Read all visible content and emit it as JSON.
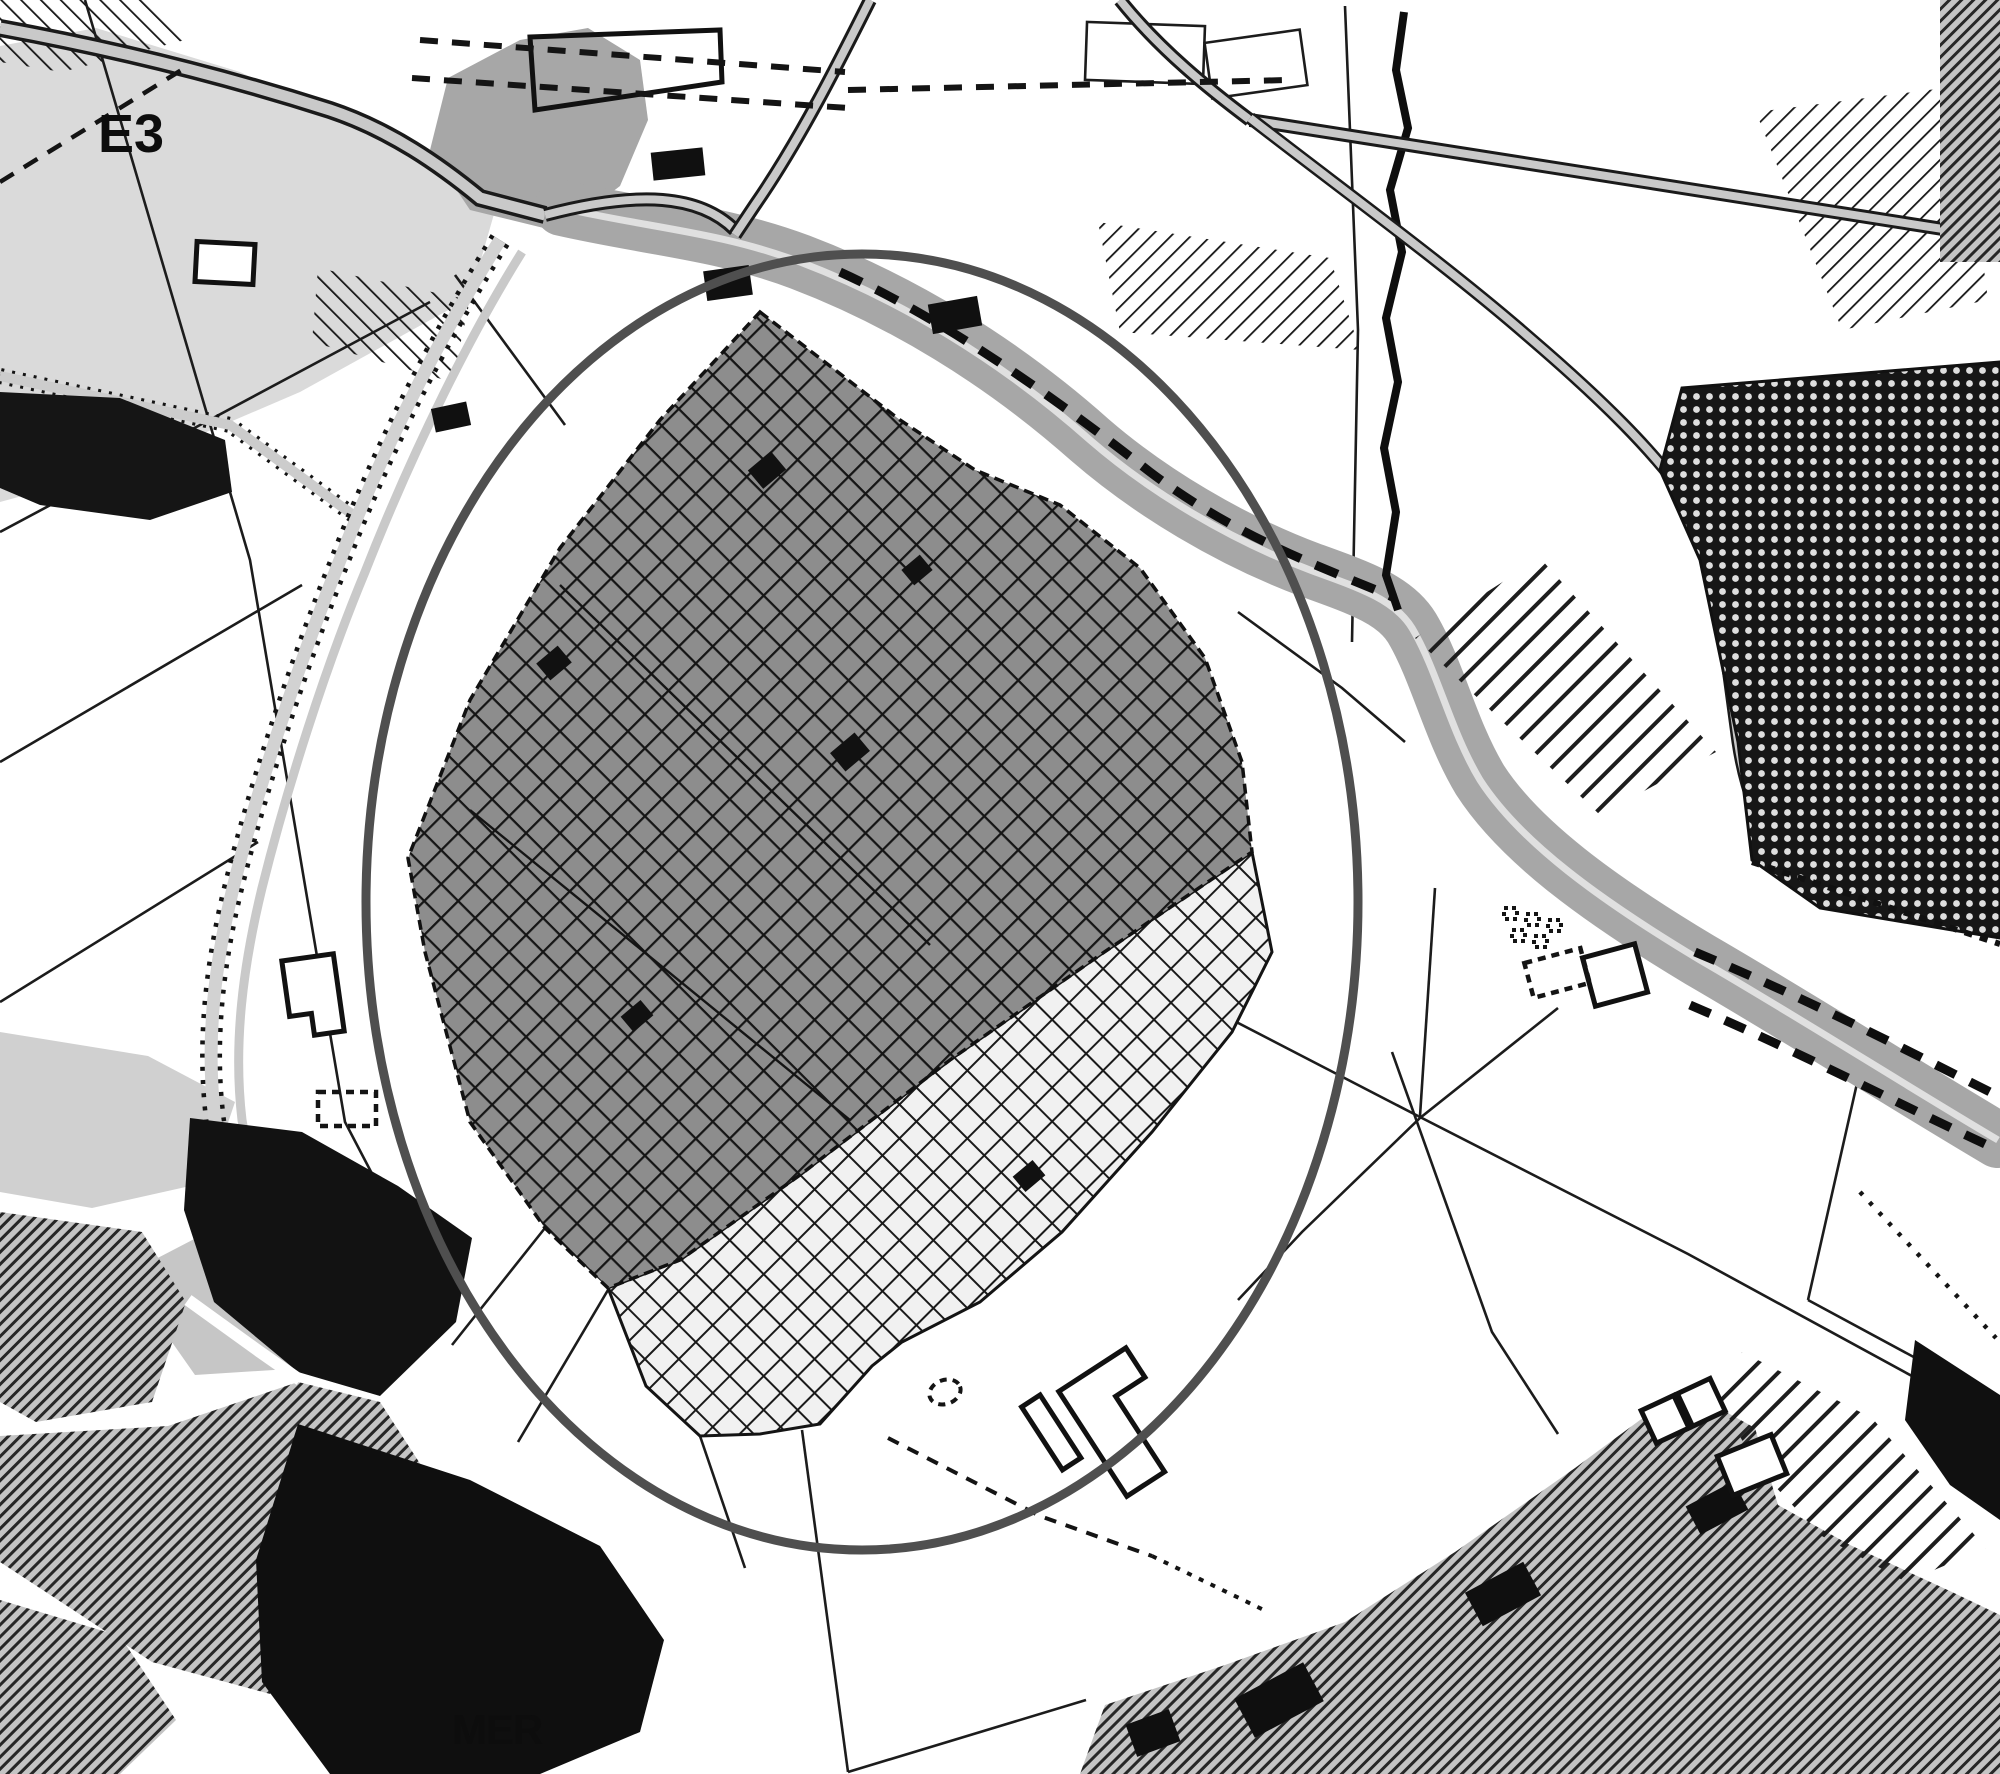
{
  "map": {
    "labels": {
      "zone_top_left": "E3",
      "zone_bottom": "MER"
    },
    "palette": {
      "background": "#ffffff",
      "parcel_line": "#1c1c1c",
      "river": "#a7a7a7",
      "river_centerline": "#e0e0e0",
      "road_fill": "#c9c9c9",
      "road_casing": "#1a1a1a",
      "zone_e3_fill": "#dadada",
      "cross_dark_cell": "#8d8d8d",
      "cross_light_cell": "#f1f1f1",
      "grid_line": "#151515",
      "dense_zone_black": "#161616",
      "dense_zone_dot": "#dedede",
      "urban_hatch_dark": "#262626",
      "building_black": "#101010",
      "ring_stroke": "#4f4f4f"
    },
    "features": [
      {
        "name": "zone-e3-area",
        "pattern": "flat-light-gray",
        "label": "E3"
      },
      {
        "name": "study-ring",
        "shape": "large-circle-outline"
      },
      {
        "name": "central-zone-dark-crosshatch",
        "pattern": "diagonal-grid-dark"
      },
      {
        "name": "central-zone-light-crosshatch",
        "pattern": "diagonal-grid-light"
      },
      {
        "name": "river-corridor",
        "pattern": "gray-band-with-centerline"
      },
      {
        "name": "railway-corridor",
        "pattern": "dotted-edge-band"
      },
      {
        "name": "northeast-dense-zone",
        "pattern": "black-with-white-dots"
      },
      {
        "name": "east-striped-band",
        "pattern": "wide-diagonal-stripes"
      },
      {
        "name": "southwest-urban-area",
        "pattern": "fine-diagonal-hatch-and-black-blocks",
        "nearby_label": "MER"
      },
      {
        "name": "southeast-urban-area",
        "pattern": "fine-diagonal-hatch"
      },
      {
        "name": "parcel-boundaries",
        "pattern": "thin-black-lines"
      },
      {
        "name": "planned-road",
        "pattern": "dashed-parallel-lines"
      }
    ]
  }
}
